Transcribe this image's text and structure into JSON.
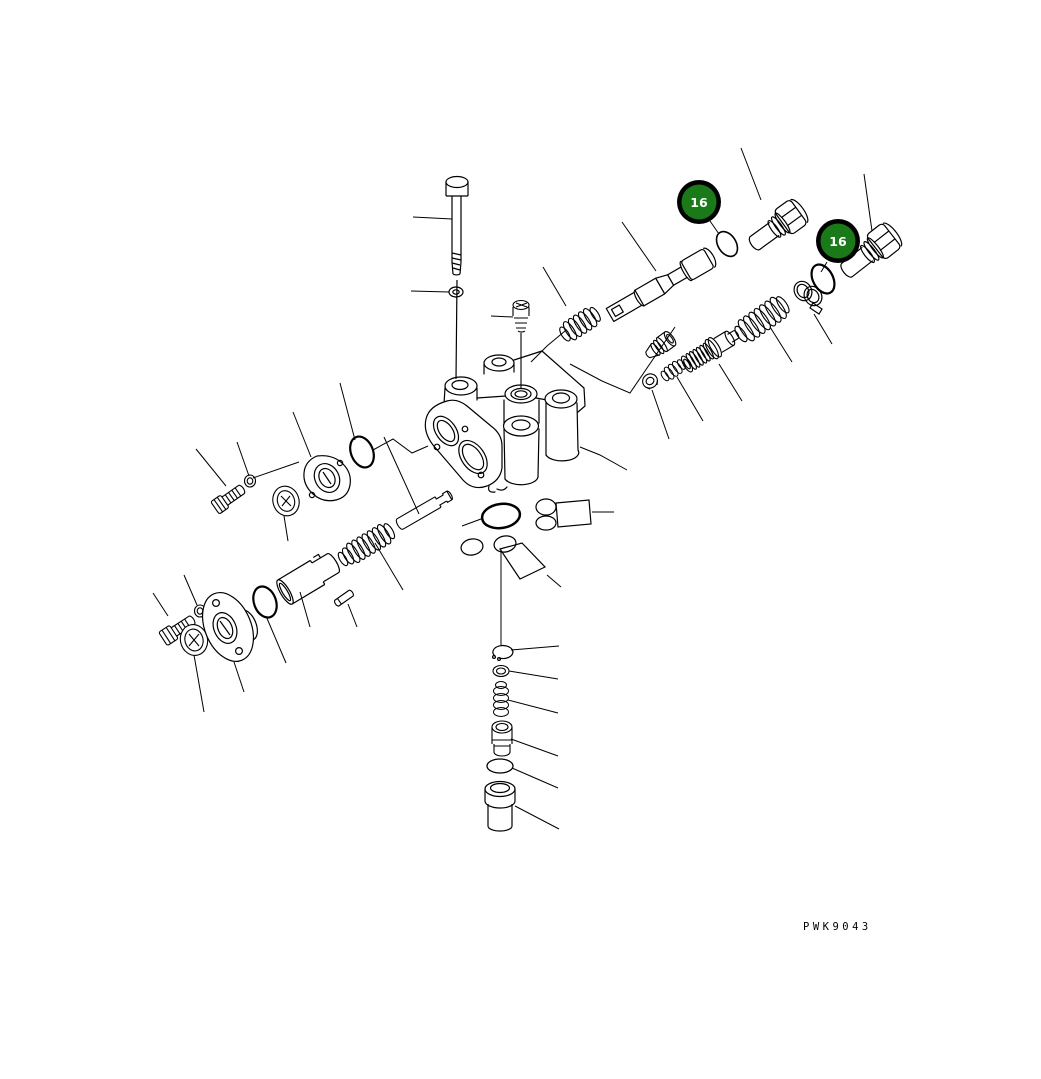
{
  "page": {
    "background": "#FFFFFF"
  },
  "diagram": {
    "type": "exploded-parts-diagram",
    "drawing_code": "PWK9043",
    "line_color": "#000000",
    "callouts": [
      {
        "label": "16",
        "fill": "#1A7A1A",
        "ring": "#000000",
        "text_color": "#FFFFFF"
      },
      {
        "label": "16",
        "fill": "#1A7A1A",
        "ring": "#000000",
        "text_color": "#FFFFFF"
      }
    ]
  }
}
